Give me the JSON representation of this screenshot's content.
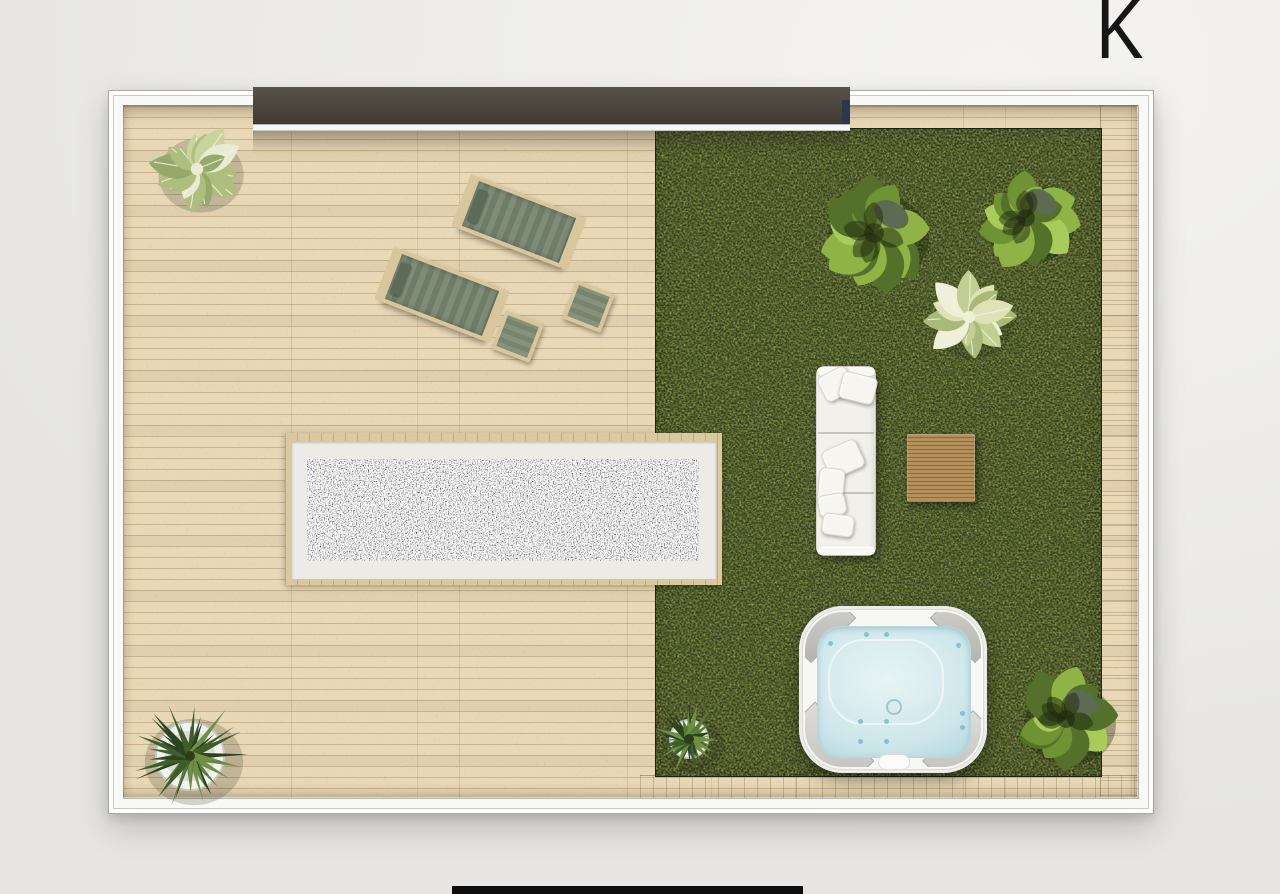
{
  "scene": {
    "label": "K"
  },
  "colors": {
    "bg": "#ecebe9",
    "letter": "#161616",
    "frame_white": "#f9f9f8",
    "frame_line": "#a9a9a7",
    "deck_base": "#e8d8b6",
    "deck_line": "#97794e",
    "grass_base": "#333d1c",
    "door_bar_top": "#58524a",
    "door_bar_bottom": "#403a33",
    "door_navy": "#27384f",
    "gravel_base": "#262622",
    "gravel_mat": "#edebe6",
    "platform_wood": "#dbc89f",
    "lounger_wood": "#d9c69d",
    "lounger_cushion": "#75836e",
    "lounger_headrest": "#5d6b59",
    "sofa_white": "#f2f0ea",
    "pillow_white": "#f7f5f0",
    "table_wood": "#b3905c",
    "table_wood_dark": "#8a6a3e",
    "tub_shell": "#f7f7f5",
    "tub_water": "#cfe7eb",
    "tub_water_light": "#e8f4f5",
    "tub_pad": "#c6c5c0",
    "pot_white": "#f2f2ef",
    "bottom_bar": "#0d0d0d"
  },
  "objects": {
    "frame": {
      "x": 108,
      "y": 90,
      "w": 1044,
      "h": 722
    },
    "deck_inner": {
      "x": 123,
      "y": 105,
      "w": 1014,
      "h": 692
    },
    "right_plank_strip": {
      "x": 1100,
      "y": 105,
      "w": 37,
      "h": 692
    },
    "bottom_plank_strip": {
      "x": 640,
      "y": 775,
      "w": 497,
      "h": 22
    },
    "grass": {
      "x": 655,
      "y": 128,
      "w": 445,
      "h": 647
    },
    "gravel_platform": {
      "x": 285,
      "y": 433,
      "w": 437,
      "h": 152
    },
    "gravel_frame": {
      "x": 291,
      "y": 441,
      "w": 424,
      "h": 137
    },
    "gravel_bed": {
      "x": 307,
      "y": 459,
      "w": 392,
      "h": 102
    },
    "lounger_1": {
      "x": 463,
      "y": 194,
      "w": 104,
      "h": 48,
      "rot": 21
    },
    "lounger_2": {
      "x": 386,
      "y": 267,
      "w": 104,
      "h": 48,
      "rot": 21
    },
    "side_table_1": {
      "x": 497,
      "y": 316,
      "w": 33,
      "h": 33,
      "rot": 21
    },
    "side_table_2": {
      "x": 568,
      "y": 286,
      "w": 33,
      "h": 33,
      "rot": 21
    },
    "sofa": {
      "x": 816,
      "y": 366,
      "w": 60,
      "h": 190
    },
    "coffee_table": {
      "x": 907,
      "y": 434,
      "w": 68,
      "h": 68
    },
    "hot_tub": {
      "x": 799,
      "y": 606,
      "w": 188,
      "h": 167
    },
    "door_bar": {
      "x": 253,
      "y": 87,
      "w": 597,
      "h": 37
    },
    "door_sill": {
      "x": 253,
      "y": 123,
      "w": 597,
      "h": 7
    },
    "door_shadow": {
      "x": 253,
      "y": 130,
      "w": 597,
      "h": 24
    },
    "bottom_bar": {
      "x": 452,
      "y": 886,
      "w": 351,
      "h": 8
    }
  },
  "plants": [
    {
      "name": "potted-palm-top-left",
      "cx": 197,
      "cy": 169,
      "r": 52,
      "type": "feather",
      "seed": 11,
      "palette": [
        "#c9d49c",
        "#e9ecd3",
        "#aebe7f",
        "#95a96b"
      ]
    },
    {
      "name": "bush-grass-top-left",
      "cx": 874,
      "cy": 233,
      "r": 62,
      "type": "bushy",
      "seed": 23,
      "palette": [
        "#8fb344",
        "#6f9232",
        "#a9cb5b",
        "#54702a"
      ]
    },
    {
      "name": "bush-grass-top-right",
      "cx": 1026,
      "cy": 218,
      "r": 55,
      "type": "bushy",
      "seed": 37,
      "palette": [
        "#8fb344",
        "#6f9232",
        "#a9cb5b",
        "#54702a"
      ]
    },
    {
      "name": "palm-pale-grass-middle",
      "cx": 969,
      "cy": 317,
      "r": 50,
      "type": "feather",
      "seed": 45,
      "palette": [
        "#dde3b4",
        "#eef0da",
        "#c3cf92",
        "#a9b97a"
      ]
    },
    {
      "name": "bush-grass-bottom-right",
      "cx": 1066,
      "cy": 719,
      "r": 56,
      "type": "bushy",
      "seed": 53,
      "palette": [
        "#8fb344",
        "#6f9232",
        "#a9cb5b",
        "#54702a"
      ]
    },
    {
      "name": "potted-yucca-bottom-left",
      "cx": 190,
      "cy": 756,
      "r": 60,
      "type": "spiky",
      "seed": 61,
      "palette": [
        "#3f5d2a",
        "#2c441d",
        "#5a7a38",
        "#6f8f47"
      ],
      "pot": {
        "r": 34,
        "color": "#f2f2ef"
      }
    },
    {
      "name": "potted-plant-grass-corner",
      "cx": 689,
      "cy": 739,
      "r": 38,
      "type": "spiky",
      "seed": 71,
      "palette": [
        "#3f5d2a",
        "#2c441d",
        "#5a7a38",
        "#6f8f47"
      ],
      "pot": {
        "r": 19,
        "color": "#efefec"
      }
    }
  ]
}
